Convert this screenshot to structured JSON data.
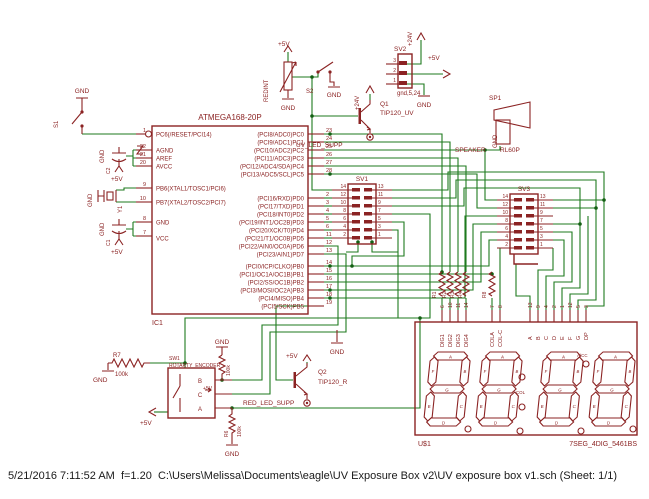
{
  "colors": {
    "component": "#8b2323",
    "net": "#1e7a1e",
    "background": "#ffffff",
    "status_text": "#1a1a1a"
  },
  "status_bar": {
    "text": "5/21/2016 7:11:52 AM  f=1.20  C:\\Users\\Melissa\\Documents\\eagle\\UV Exposure Box v2\\UV exposure box v1.sch (Sheet: 1/1)"
  },
  "power": {
    "p5": "+5V",
    "p24": "+24V",
    "gnd": "GND"
  },
  "ic": {
    "ref": "IC1",
    "title": "ATMEGA168-20P",
    "left": [
      [
        "1",
        "PC6(/RESET/PCI14)"
      ],
      [
        "22",
        "AGND"
      ],
      [
        "21",
        "AREF"
      ],
      [
        "20",
        "AVCC"
      ],
      [
        "9",
        "PB6(XTAL1/TOSC1/PCI6)"
      ],
      [
        "10",
        "PB7(XTAL2/TOSC2/PCI7)"
      ],
      [
        "8",
        "GND"
      ],
      [
        "7",
        "VCC"
      ]
    ],
    "pc": [
      [
        "23",
        "(PCI8/ADC0)PC0"
      ],
      [
        "24",
        "(PCI9/ADC1)PC1"
      ],
      [
        "25",
        "(PCI10/ADC2)PC2"
      ],
      [
        "26",
        "(PCI11/ADC3)PC3"
      ],
      [
        "27",
        "(PCI12/ADC4/SDA)PC4"
      ],
      [
        "28",
        "(PCI13/ADC5/SCL)PC5"
      ]
    ],
    "pd": [
      [
        "2",
        "(PCI16/RXD)PD0"
      ],
      [
        "3",
        "(PCI17/TXD)PD1"
      ],
      [
        "4",
        "(PCI18/INT0)PD2"
      ],
      [
        "5",
        "(PCI19/INT1/OC2B)PD3"
      ],
      [
        "6",
        "(PCI20/XCK/T0)PD4"
      ],
      [
        "11",
        "(PCI21/T1/OC0B)PD5"
      ],
      [
        "12",
        "(PCI22/AIN0/OC0A)PD6"
      ],
      [
        "13",
        "(PCI23/AIN1)PD7"
      ]
    ],
    "pb": [
      [
        "14",
        "(PCI0/ICP/CLKO)PB0"
      ],
      [
        "15",
        "(PCI1/OC1A/OC1B)PB1"
      ],
      [
        "16",
        "(PCI2/SS/OC1B)PB2"
      ],
      [
        "17",
        "(PCI3/MOSI/OC2A)PB3"
      ],
      [
        "18",
        "(PCI4/MISO)PB4"
      ],
      [
        "19",
        "(PCI5/SCK)PB5"
      ]
    ]
  },
  "sw": {
    "s1": "S1",
    "s2": "S2",
    "sw1": "SW1",
    "sw1_val": "ROTARTY_ENCODER",
    "enc_pins": [
      "B",
      "C",
      "A"
    ]
  },
  "xtal": {
    "y1": "Y1"
  },
  "caps": {
    "c1": "C1",
    "c2": "C2"
  },
  "pot": {
    "name": "REDINT"
  },
  "q1": {
    "ref": "Q1",
    "val": "TIP120_UV"
  },
  "q2": {
    "ref": "Q2",
    "val": "TIP120_R"
  },
  "sv1": {
    "title": "SV1"
  },
  "sv3": {
    "title": "SV3"
  },
  "sv2": {
    "title": "SV2",
    "val": "gnd,5,24",
    "pins": [
      "3",
      "2",
      "1"
    ]
  },
  "hdr": {
    "l": [
      "14",
      "12",
      "10",
      "8",
      "6",
      "4",
      "2"
    ],
    "r": [
      "13",
      "11",
      "9",
      "7",
      "5",
      "3",
      "1"
    ]
  },
  "sp": {
    "ref": "SP1",
    "name": "SPEAKER",
    "val": "RL60P"
  },
  "res": {
    "r7": "R7",
    "r7v": "100k",
    "r6": "R6",
    "r6v": "100k",
    "rencv": "100k",
    "r8": "R8",
    "group": [
      "R1",
      "R2",
      "R3",
      "R4"
    ]
  },
  "nets": {
    "uv": "UV_LED_SUPP",
    "red": "RED_LED_SUPP"
  },
  "disp": {
    "ref": "U$1",
    "val": "7SEG_4DIG_5461BS",
    "dig": [
      "DIG1",
      "DIG2",
      "DIG3",
      "DIG4"
    ],
    "dign": [
      "6",
      "10",
      "11",
      "14"
    ],
    "col": [
      "COLA",
      "COL-C"
    ],
    "coln": [
      "7",
      "8"
    ],
    "seg": [
      "A",
      "B",
      "C",
      "D",
      "E",
      "F",
      "G",
      "DP"
    ],
    "segn": [
      "13",
      "9",
      "4",
      "2",
      "1",
      "12",
      "5",
      "3"
    ],
    "letters": [
      "A",
      "B",
      "C",
      "D",
      "E",
      "F",
      "G"
    ],
    "colmark": "COL",
    "accmark": "A/CC"
  }
}
